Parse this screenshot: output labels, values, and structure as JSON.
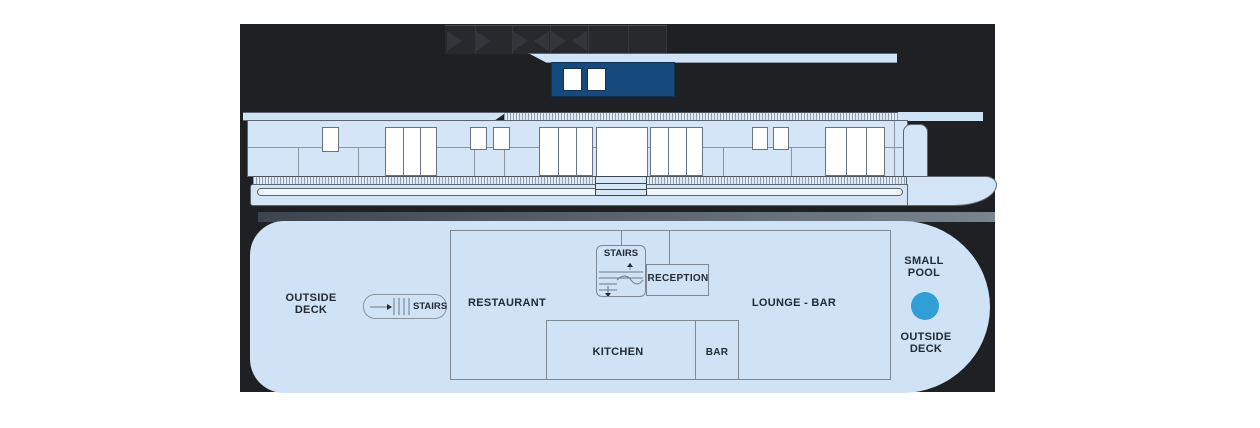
{
  "colors": {
    "page_background": "#ffffff",
    "panel_dark": "#1f2023",
    "plan_light_blue": "#cfe2f6",
    "profile_light_blue": "#d4e5f7",
    "wheelhouse_blue": "#174a7c",
    "pool_blue": "#2f9fd6",
    "outline_gray": "#5c6672",
    "wall_gray": "#7e8895",
    "text_dark": "#222b36"
  },
  "icons": {
    "deck_chairs": "triangle-deck-chair-silhouettes",
    "stairs_treads": "stair-tread-lines",
    "direction_arrows": "small-direction-arrows",
    "pool": "filled-circle"
  },
  "deck_plan": {
    "outside_deck_left": [
      "OUTSIDE",
      "DECK"
    ],
    "stairs_left_label": "STAIRS",
    "restaurant_label": "RESTAURANT",
    "stairs_center_label": "STAIRS",
    "reception_label": "RECEPTION",
    "kitchen_label": "KITCHEN",
    "bar_label": "BAR",
    "lounge_bar_label": "LOUNGE - BAR",
    "small_pool": [
      "SMALL",
      "POOL"
    ],
    "outside_deck_right": [
      "OUTSIDE",
      "DECK"
    ]
  }
}
